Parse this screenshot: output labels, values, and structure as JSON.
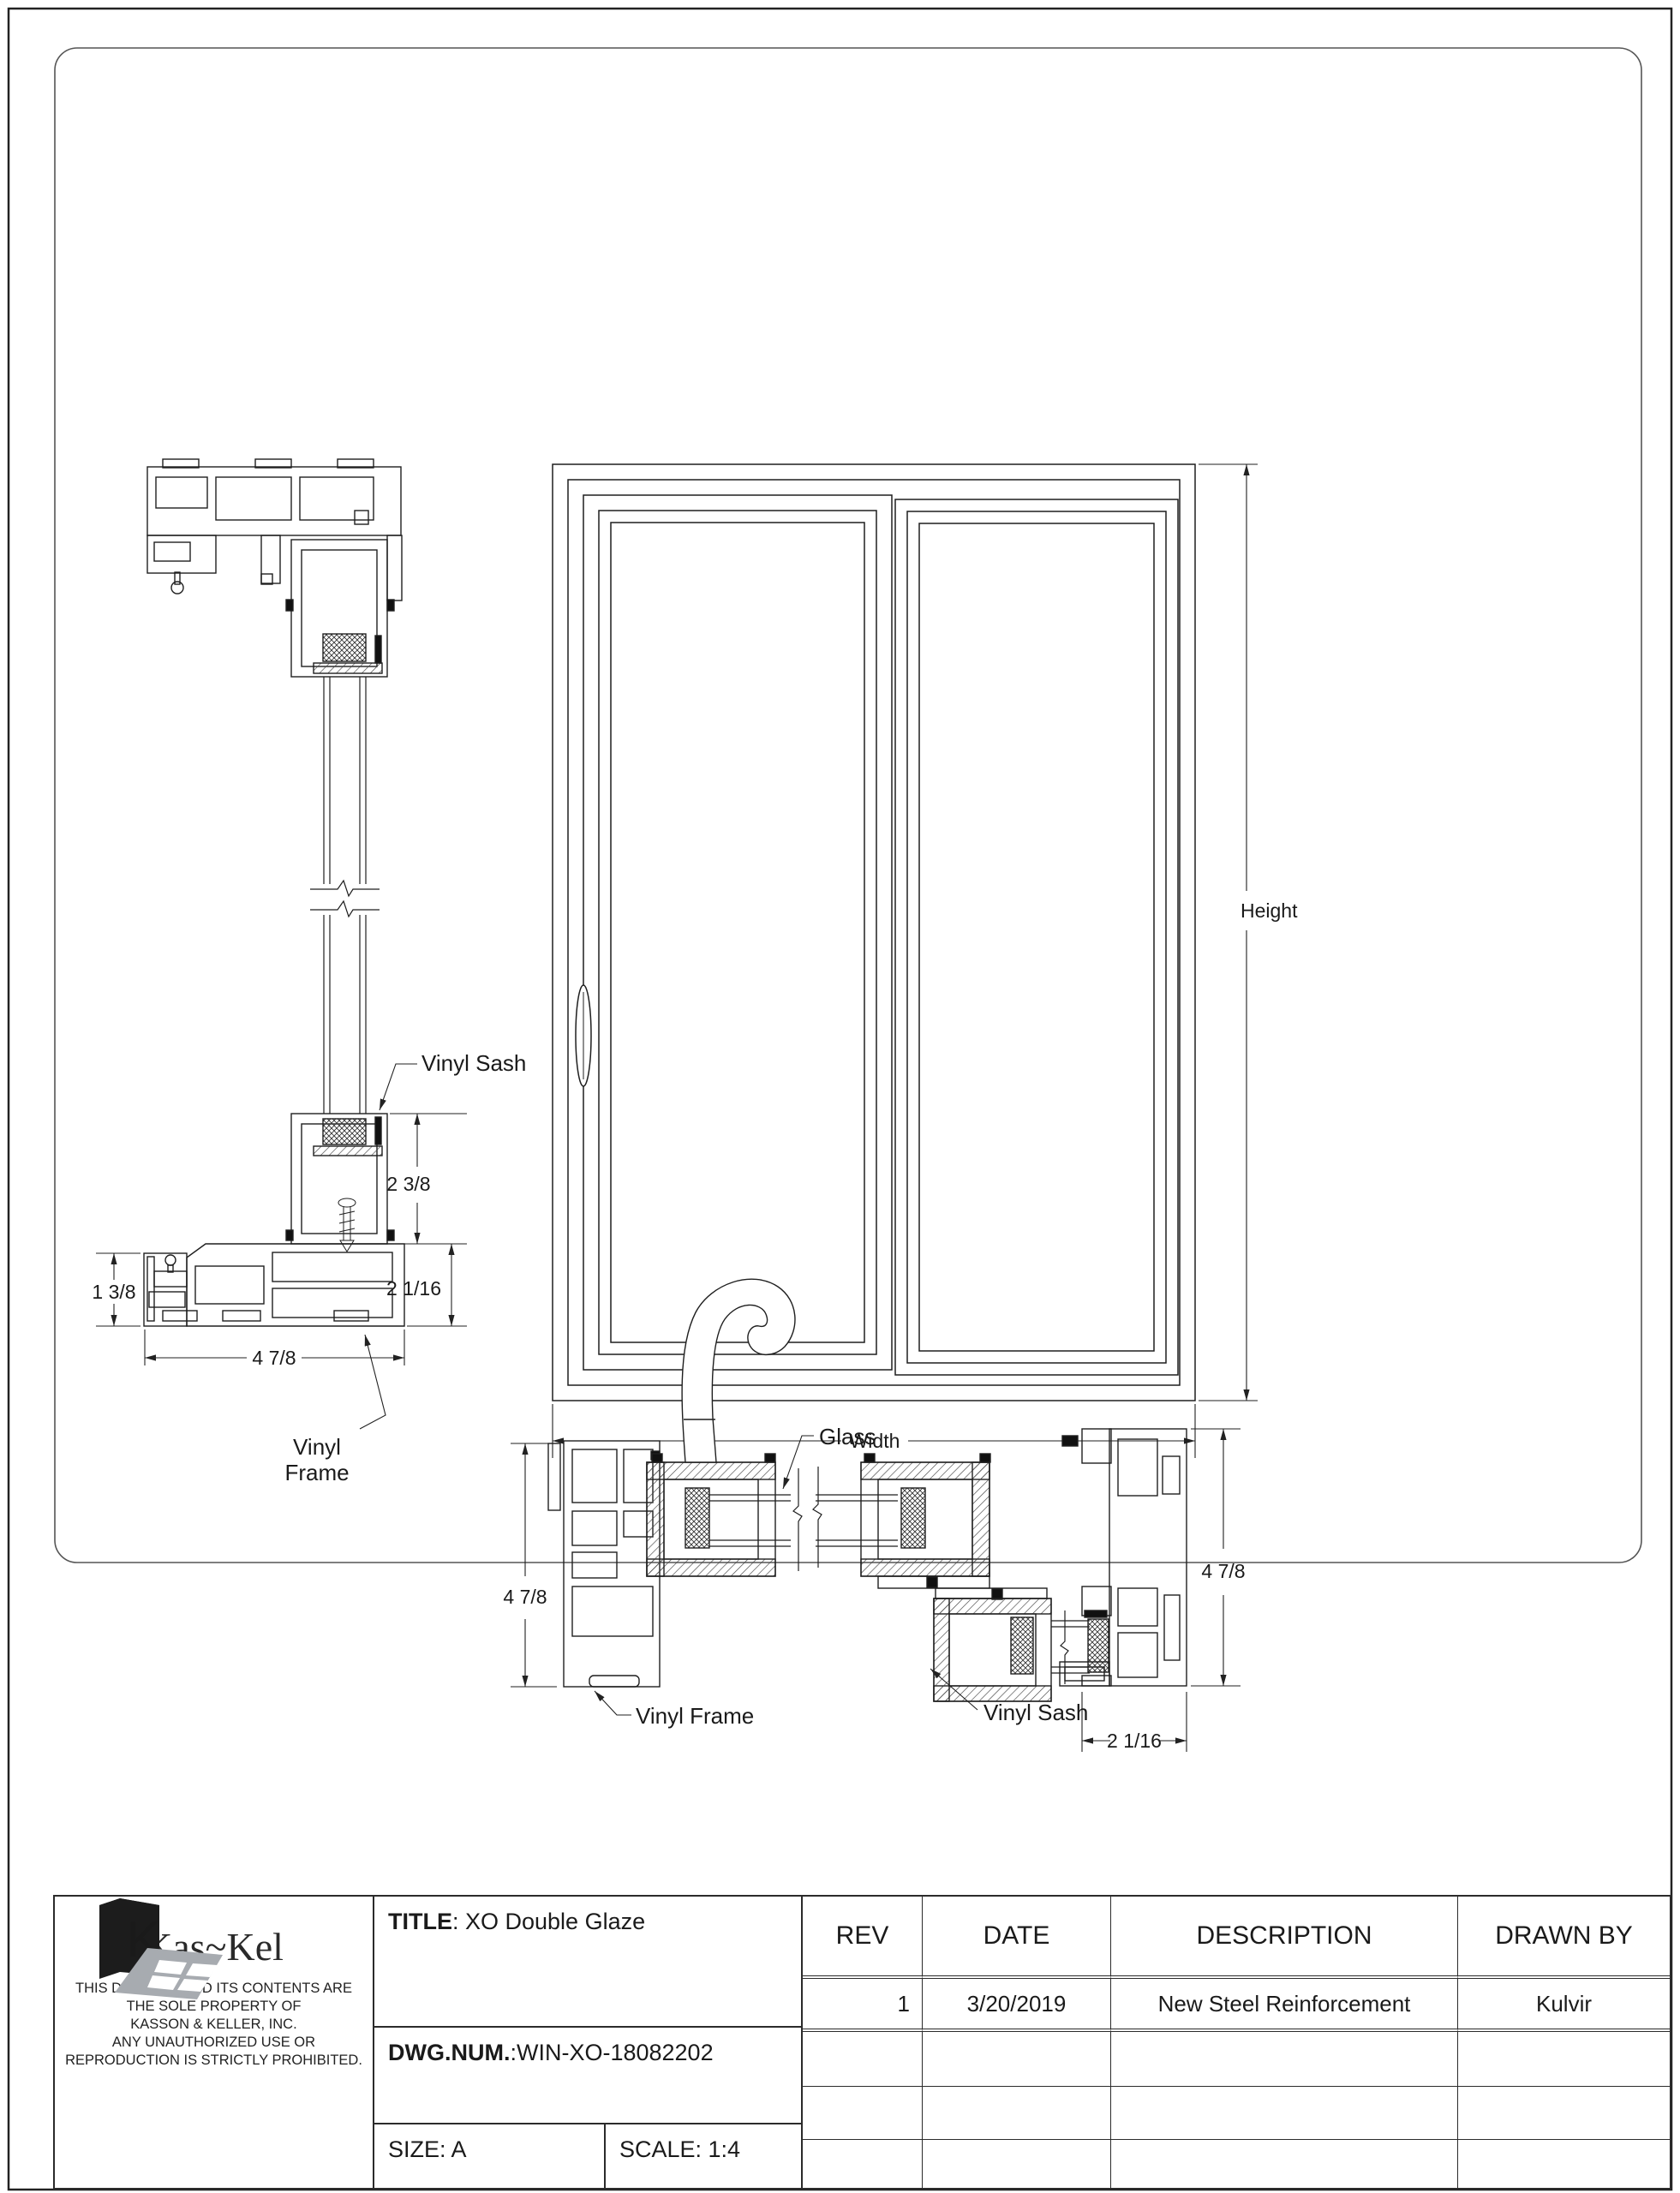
{
  "drawing": {
    "elevation": {
      "height_label": "Height",
      "width_label": "Width"
    },
    "section_left": {
      "vinyl_sash_label": "Vinyl Sash",
      "vinyl_frame_label_line1": "Vinyl",
      "vinyl_frame_label_line2": "Frame",
      "dim_sash_depth": "2 3/8",
      "dim_frame_depth": "2 1/16",
      "dim_frame_height": "1 3/8",
      "dim_frame_width": "4 7/8"
    },
    "section_bottom": {
      "glass_label": "Glass",
      "vinyl_sash_label": "Vinyl Sash",
      "vinyl_frame_label": "Vinyl Frame",
      "dim_left_jamb": "4 7/8",
      "dim_right_jamb": "4 7/8",
      "dim_sash": "2 1/16"
    }
  },
  "title_block": {
    "logo_text": "Kas~Kel",
    "legal_lines": [
      "THIS DRAWING AND ITS CONTENTS ARE",
      "THE SOLE PROPERTY OF",
      "KASSON & KELLER, INC.",
      "ANY UNAUTHORIZED USE OR",
      "REPRODUCTION IS STRICTLY PROHIBITED."
    ],
    "title_label": "TITLE",
    "title_value": ": XO Double Glaze",
    "dwg_label": "DWG.NUM.",
    "dwg_value": ":WIN-XO-18082202",
    "size_value": "SIZE: A",
    "scale_value": "SCALE: 1:4",
    "revisions": {
      "headers": [
        "REV",
        "DATE",
        "DESCRIPTION",
        "DRAWN BY"
      ],
      "rows": [
        {
          "rev": "1",
          "date": "3/20/2019",
          "description": "New Steel Reinforcement",
          "drawn_by": "Kulvir"
        },
        {
          "rev": "",
          "date": "",
          "description": "",
          "drawn_by": ""
        },
        {
          "rev": "",
          "date": "",
          "description": "",
          "drawn_by": ""
        },
        {
          "rev": "",
          "date": "",
          "description": "",
          "drawn_by": ""
        }
      ]
    }
  }
}
